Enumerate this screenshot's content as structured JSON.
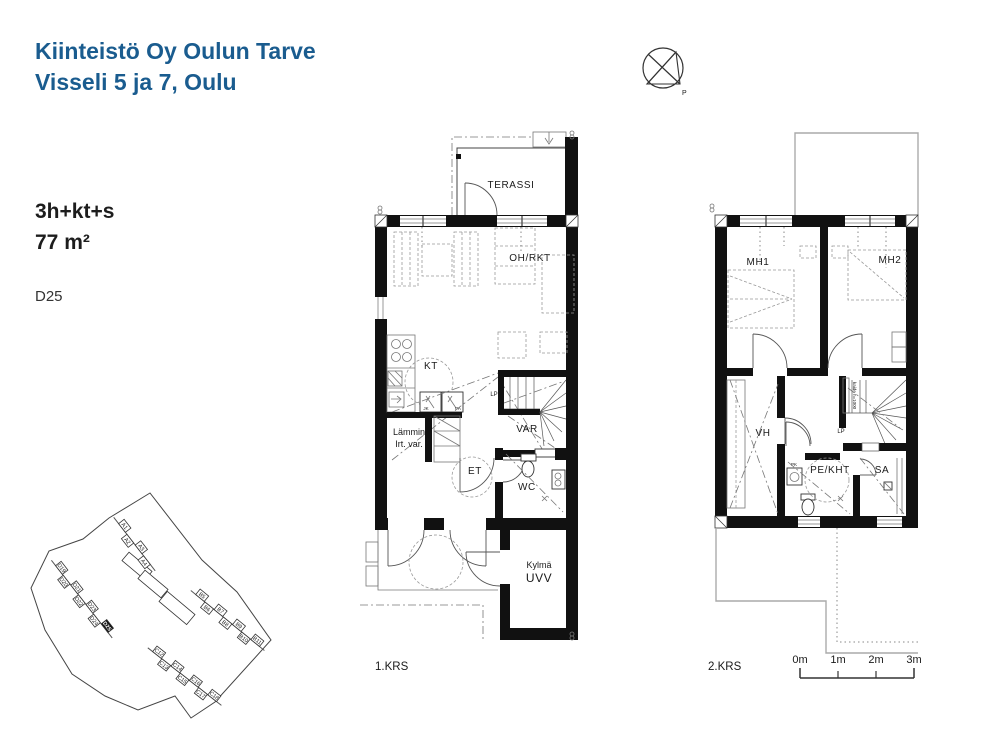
{
  "header": {
    "title_line1": "Kiinteistö Oy Oulun Tarve",
    "title_line2": "Visseli 5 ja 7, Oulu"
  },
  "apartment": {
    "layout": "3h+kt+s",
    "area": "77 m²",
    "unit": "D25"
  },
  "compass": {
    "north_label": "P"
  },
  "floor1": {
    "label": "1.KRS",
    "terrace": "TERASSI",
    "living_kitchen": "OH/RKT",
    "kitchen": "KT",
    "stair_landing": "LP",
    "storage": "VAR",
    "fridge": "JK",
    "freezer": "PA",
    "warm_storage_line1": "Lämmin",
    "warm_storage_line2": "Irt. var.",
    "entry": "ET",
    "wc": "WC",
    "cold_storage_line1": "Kylmä",
    "cold_storage_line2": "UVV"
  },
  "floor2": {
    "label": "2.KRS",
    "bedroom1": "MH1",
    "bedroom2": "MH2",
    "closet": "VH",
    "stair_landing": "LP",
    "railing_note": "kaide h=1000",
    "bathroom": "PE/KHT",
    "sauna": "SA",
    "washer": "PK"
  },
  "scale_bar": {
    "labels": [
      "0m",
      "1m",
      "2m",
      "3m"
    ]
  },
  "site_map": {
    "highlight": "D25",
    "boundary": "125,15 84,40 58,61 24,73 6,110 20,152 47,196 80,218 113,232 150,218 166,240 190,224 246,162 212,114 177,82",
    "rows": [
      {
        "angle": 52,
        "start": [
          97,
          50
        ],
        "step": [
          8.3,
          10.7
        ],
        "labels": [
          "A1",
          "A2",
          "A3",
          "A4"
        ]
      },
      {
        "angle": 52,
        "start": [
          34,
          92
        ],
        "step": [
          7.6,
          9.7
        ],
        "labels": [
          "D19",
          "D20",
          "D21",
          "D22",
          "D23",
          "D24",
          "D25"
        ]
      },
      {
        "angle": 39,
        "start": [
          175,
          120
        ],
        "step": [
          9.2,
          7.5
        ],
        "labels": [
          "B5",
          "B6",
          "B7",
          "B8",
          "B9",
          "B10",
          "B11"
        ]
      },
      {
        "angle": 38,
        "start": [
          132,
          177
        ],
        "step": [
          9.2,
          7.2
        ],
        "labels": [
          "C12",
          "C13",
          "C14",
          "C15",
          "C16",
          "C17",
          "C18"
        ]
      }
    ],
    "extras": [
      {
        "x": 112,
        "y": 88,
        "w": 30,
        "h": 11,
        "angle": 40
      },
      {
        "x": 128,
        "y": 106,
        "w": 30,
        "h": 11,
        "angle": 40
      },
      {
        "x": 152,
        "y": 130,
        "w": 36,
        "h": 13,
        "angle": 40
      }
    ]
  }
}
